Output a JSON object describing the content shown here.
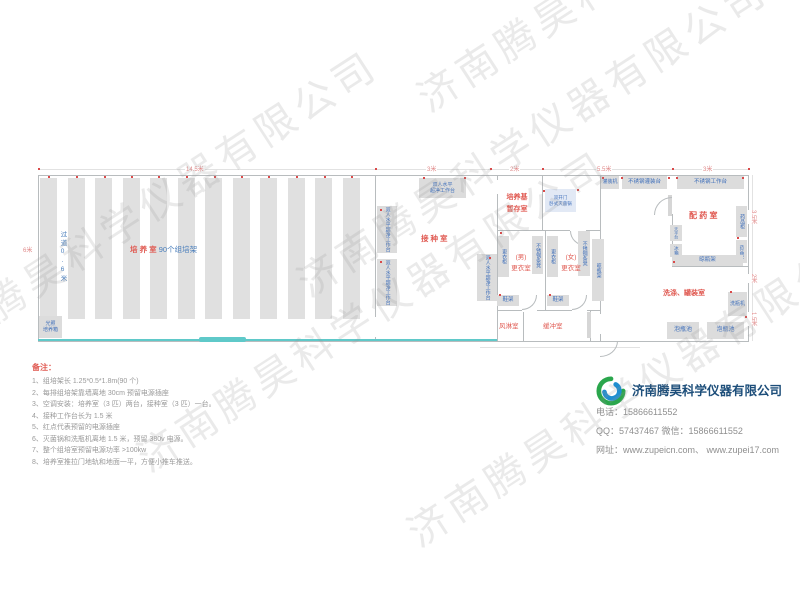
{
  "watermark": "济南腾昊科学仪器有限公司",
  "dimensions": {
    "top1": "14.5米",
    "top2": "3米",
    "top3": "2米",
    "top4": "5.5米",
    "top5": "3米",
    "right1": "3.5米",
    "right2": "2米",
    "right3": "1.5米",
    "left1": "6米"
  },
  "rooms": {
    "culture": {
      "name": "培 养 室",
      "racks": "90个组培架",
      "aisle": "过道0.6米"
    },
    "inoculation": {
      "name": "接种室"
    },
    "medium_storage": {
      "line1": "培养基",
      "line2": "暂存室"
    },
    "men_changing": {
      "line1": "(男)",
      "line2": "更衣室"
    },
    "women_changing": {
      "line1": "(女)",
      "line2": "更衣室"
    },
    "air_shower": {
      "name": "风淋室"
    },
    "buffer": {
      "name": "缓冲室"
    },
    "dispensing": {
      "name": "配 药 室"
    },
    "washing": {
      "name": "洗涤、罐装室"
    }
  },
  "equipment": {
    "clean_bench": "双人水平超净工作台",
    "clean_bench_l1": "双人水平",
    "clean_bench_l2": "超净工作台",
    "sterilizer_l1": "双开门",
    "sterilizer_l2": "卧式灭菌锅",
    "incubator_l1": "光照",
    "incubator_l2": "培养箱",
    "locker": "更衣柜",
    "steel_bench": "不锈钢条凳",
    "shoe_rack": "鞋架",
    "drying_rack": "晾瓶架",
    "filling_machine": "灌装机",
    "filling_table": "不锈钢灌装台",
    "work_table": "不锈钢工作台",
    "medicine_cabinet": "药品柜",
    "balance_table": "天平台",
    "fridge": "冰箱",
    "bottle_washer": "洗瓶机",
    "soak_pool": "泡瓶池"
  },
  "notes": {
    "title": "备注：",
    "items": [
      "1、组培架长 1.25*0.5*1.8m(90 个)",
      "2、每排组培架靠墙离地 30cm 预留电源插座",
      "3、空调安装：培养室（3 匹）两台，接种室（3 匹）一台。",
      "4、接种工作台长为 1.5 米",
      "5、红点代表预留的电源插座",
      "6、灭菌锅和洗瓶机离地 1.5 米，预留 380v 电源。",
      "7、整个组培室预留电源功率 >100kw",
      "8、培养室推拉门地轨和地面一平，方便小推车推送。"
    ]
  },
  "company": {
    "name": "济南腾昊科学仪器有限公司",
    "phone_line": "电话：15866611552",
    "qq_line": "QQ：57437467    微信：15866611552",
    "web_line": "网址：www.zupeicn.com、 www.zupei17.com"
  }
}
